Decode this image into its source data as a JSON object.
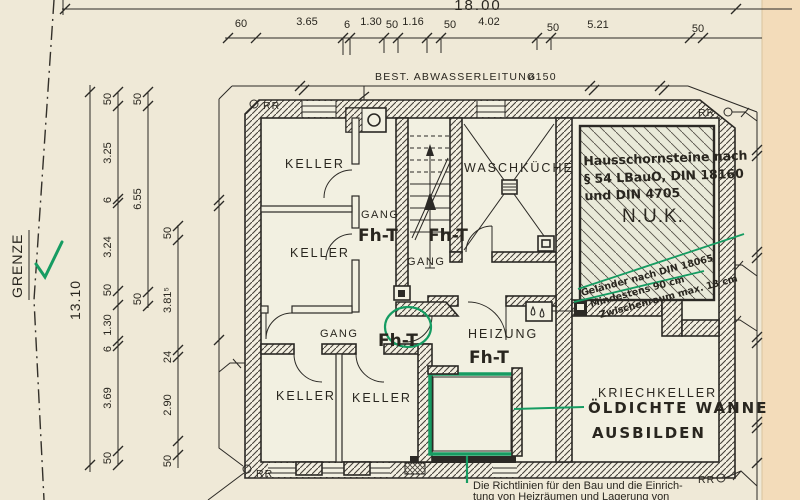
{
  "labels": {
    "grenze": "GRENZE",
    "pipe": "BEST. ABWASSERLEITUNG",
    "pipe_dia": "ø150"
  },
  "dims": {
    "overall_top": "18.00",
    "overall_left": "13.10",
    "top_chain": [
      "60",
      "3.65",
      "6",
      "1.30",
      "50",
      "1.16",
      "50",
      "4.02",
      "50",
      "5.21",
      "50"
    ],
    "left_a": [
      "50",
      "3.25",
      "6",
      "3.24",
      "50",
      "1.30",
      "6",
      "3.69",
      "50"
    ],
    "left_b": [
      "50",
      "6.55",
      "50"
    ],
    "left_c": [
      "50",
      "3.81⁵",
      "24",
      "2.90",
      "50"
    ]
  },
  "rooms": {
    "keller": "KELLER",
    "gang": "GANG",
    "waschkueche": "WASCHKÜCHE",
    "nuk": "N.U.K.",
    "heizung": "HEIZUNG",
    "kriechkeller": "KRIECHKELLER"
  },
  "green": {
    "fht": "Fh-T",
    "chimney_note": [
      "Hausschornsteine nach",
      "§ 54 LBauO, DIN 18160",
      "und DIN 4705"
    ],
    "diag_note": [
      "Geländer nach DIN 18065",
      "Mindestens 90 cm",
      "Zwischenraum max. 13 cm"
    ],
    "oil_note": [
      "ÖLDICHTE WANNE",
      "AUSBILDEN"
    ],
    "rules_note": [
      "Die Richtlinien für den Bau und die Einrich-",
      "tung von Heizräumen und Lagerung von"
    ]
  },
  "marks": {
    "rr": "RR"
  },
  "colors": {
    "ink_green": "#169c62",
    "print_teal": "#2f9c8e",
    "line": "#2b2925",
    "paper": "#efe9d7",
    "margin": "#f3dcba"
  }
}
